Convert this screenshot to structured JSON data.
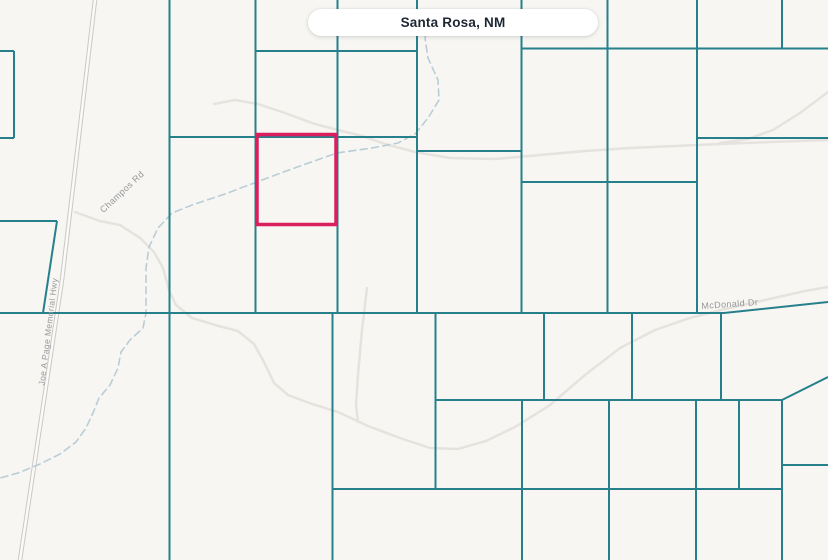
{
  "location_pill": {
    "label": "Santa Rosa, NM"
  },
  "road_labels": [
    {
      "text": "Joe A Page Memorial Hwy",
      "x": 51,
      "y": 332,
      "rotation": -83,
      "size": 8.5
    },
    {
      "text": "Champos Rd",
      "x": 124,
      "y": 194,
      "rotation": -43,
      "size": 9
    },
    {
      "text": "McDonald Dr",
      "x": 730,
      "y": 307,
      "rotation": -4,
      "size": 9
    }
  ],
  "colors": {
    "background": "#f7f6f2",
    "parcel_line": "#26808b",
    "highlight": "#da1f5f",
    "stream": "#b9cdd6",
    "road_faint": "#e6e3de",
    "highway_casing": "#cbc9c5",
    "highway_fill": "#fafaf8",
    "label_text": "#94979b"
  },
  "map_geometry": {
    "highlight_parcel": {
      "x": 257,
      "y": 134.5,
      "width": 79,
      "height": 90
    },
    "parcel_segments": [
      [
        169.5,
        0,
        169.5,
        560
      ],
      [
        255.5,
        0,
        255.5,
        313
      ],
      [
        337.5,
        0,
        337.5,
        313
      ],
      [
        417,
        0,
        417,
        313
      ],
      [
        521.5,
        0,
        521.5,
        313
      ],
      [
        607.5,
        0,
        607.5,
        313
      ],
      [
        697,
        0,
        697,
        313
      ],
      [
        782,
        0,
        782,
        48.5
      ],
      [
        255.5,
        51,
        417,
        51
      ],
      [
        521.5,
        48.5,
        828,
        48.5
      ],
      [
        169.5,
        137,
        417,
        137
      ],
      [
        417,
        151,
        521.5,
        151
      ],
      [
        521.5,
        182,
        697,
        182
      ],
      [
        697,
        138,
        828,
        138
      ],
      [
        0,
        51,
        14,
        51
      ],
      [
        14,
        51,
        14,
        138
      ],
      [
        0,
        138,
        14,
        138
      ],
      [
        0,
        221,
        57,
        221
      ],
      [
        57,
        221,
        43,
        313
      ],
      [
        332.5,
        313,
        332.5,
        560
      ],
      [
        435.5,
        313,
        435.5,
        489
      ],
      [
        544,
        313,
        544,
        400
      ],
      [
        632,
        313,
        632,
        400
      ],
      [
        721,
        313,
        721,
        400
      ],
      [
        435.5,
        400,
        782,
        400
      ],
      [
        782,
        400,
        828,
        377
      ],
      [
        522,
        400,
        522,
        560
      ],
      [
        609,
        400,
        609,
        560
      ],
      [
        696,
        400,
        696,
        560
      ],
      [
        739,
        400,
        739,
        489
      ],
      [
        782,
        400,
        782,
        560
      ],
      [
        332.5,
        489,
        782,
        489
      ],
      [
        782,
        465,
        828,
        465
      ]
    ],
    "parcel_paths": [
      "M0,313 L724,313 L828,302"
    ],
    "highway": {
      "path": "M95,0 L62,280 L20,560"
    },
    "stream": {
      "path": "M433,12 L425,38 L428,58 L438,80 L439,100 L428,118 L415,134 L398,143 L372,148 L337,153 L300,166 L262,180 L225,194 L192,205 L172,213 L158,228 L149,247 L146,268 L146,313 L143,328 L130,340 L121,352 L118,368 L110,385 L99,398 L93,413 L86,428 L76,442 L60,454 L40,464 L18,473 L0,478"
    },
    "faint_roads": [
      "M75,212 L100,221 L120,225 L140,238 L154,252 L163,268 L169,290 L176,305 L192,318 L215,325 L238,331 L254,344 L264,362 L274,383 L288,395 L312,404 L338,412 L368,426 L400,438 L430,448 L458,449 L486,441 L515,427 L550,405 L585,375 L620,348 L655,330 L690,318 L725,309 L765,300 L805,291 L828,287",
      "M214,104 L235,100 L258,104 L285,113 L315,124 L342,131 L362,136 L385,144 L415,152 L450,158 L495,159 L540,155 L585,151 L630,148 L675,146 L720,144 L770,142 L828,140",
      "M367,288 L362,330 L358,375 L356,405 L358,422",
      "M828,92 L800,113 L773,130 L748,139 L720,143"
    ]
  }
}
